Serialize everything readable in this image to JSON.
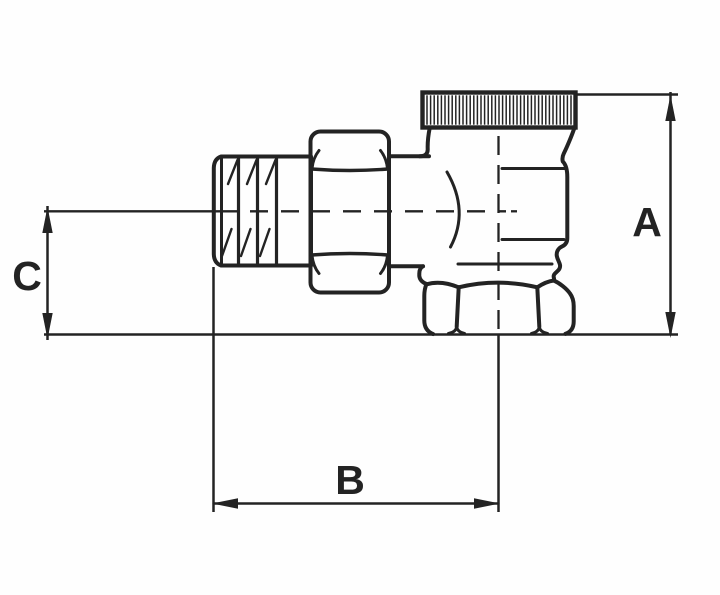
{
  "drawing": {
    "description": "Technical side-view drawing of an angle radiator valve (male thread, union hex nut, valve body with knurled bonnet cap and bottom outlet hex nut) with three dimension callouts",
    "line_color": "#232323",
    "background_color": "#fefefe",
    "dimensions": {
      "height_label": "A",
      "length_label": "B",
      "offset_label": "C"
    }
  }
}
